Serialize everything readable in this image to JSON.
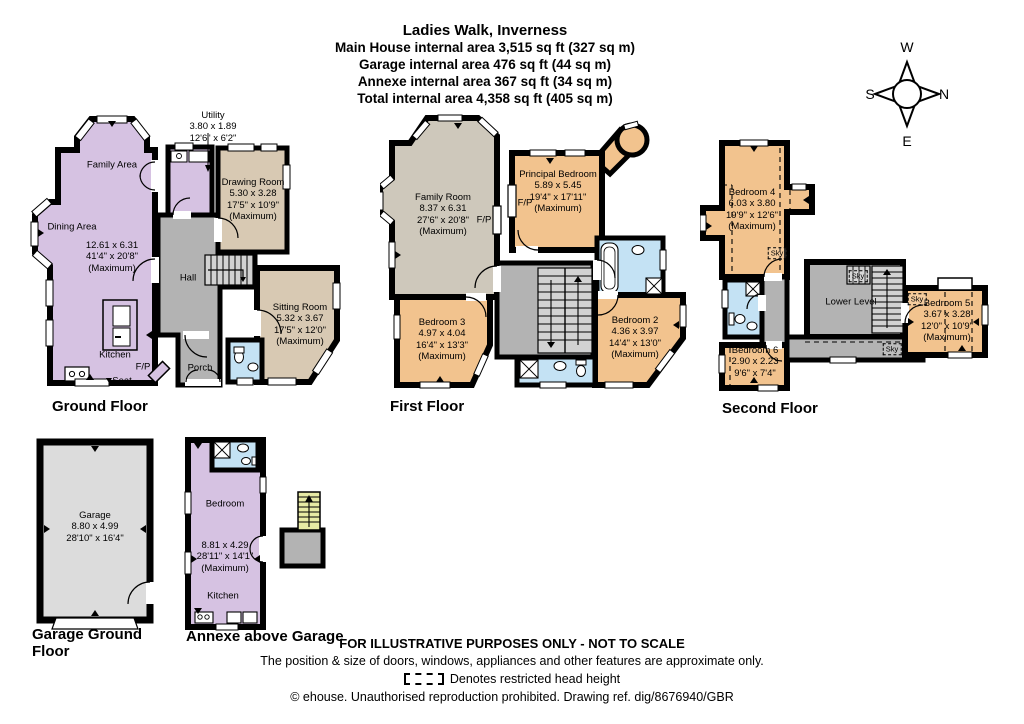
{
  "header": {
    "title": "Ladies Walk, Inverness",
    "area_lines": [
      "Main House internal area 3,515 sq ft (327 sq m)",
      "Garage internal area 476 sq ft (44 sq m)",
      "Annexe internal area 367 sq ft (34 sq m)",
      "Total internal area 4,358 sq ft (405 sq m)"
    ]
  },
  "compass": {
    "top": "W",
    "left": "S",
    "right": "N",
    "bottom": "E"
  },
  "colors": {
    "wall": "#000000",
    "lavender": "#d6c2e2",
    "beige": "#d8c9b3",
    "orange": "#f2c38e",
    "taupe": "#cec8bb",
    "gray": "#b3b3b3",
    "light_gray": "#dcdcdc",
    "stair_gray": "#d2d2d2",
    "blue": "#c4e2f4",
    "stair_yellow": "#e7eaa4",
    "white": "#ffffff"
  },
  "ground_floor": {
    "label": "Ground Floor",
    "family_area": "Family Area",
    "dining_area": "Dining Area",
    "kitchen": "Kitchen",
    "open_plan_dims": [
      "12.61 x 6.31",
      "41'4\" x 20'8\"",
      "(Maximum)"
    ],
    "utility": [
      "Utility",
      "3.80 x 1.89",
      "12'6\" x 6'2\""
    ],
    "drawing_room": [
      "Drawing Room",
      "5.30 x 3.28",
      "17'5\" x 10'9\"",
      "(Maximum)"
    ],
    "sitting_room": [
      "Sitting Room",
      "5.32 x 3.67",
      "17'5\" x 12'0\"",
      "(Maximum)"
    ],
    "hall": "Hall",
    "porch": "Porch",
    "fireplace": "F/P",
    "seat": "Seat"
  },
  "first_floor": {
    "label": "First Floor",
    "family_room": [
      "Family Room",
      "8.37 x 6.31",
      "27'6\" x 20'8\"",
      "(Maximum)"
    ],
    "principal_bedroom": [
      "Principal Bedroom",
      "5.89 x 5.45",
      "19'4\" x 17'11\"",
      "(Maximum)"
    ],
    "bedroom_3": [
      "Bedroom 3",
      "4.97 x 4.04",
      "16'4\" x 13'3\"",
      "(Maximum)"
    ],
    "bedroom_2": [
      "Bedroom 2",
      "4.36 x 3.97",
      "14'4\" x 13'0\"",
      "(Maximum)"
    ],
    "fireplace": "F/P"
  },
  "second_floor": {
    "label": "Second Floor",
    "bedroom_4": [
      "Bedroom 4",
      "6.03 x 3.80",
      "19'9\" x 12'6\"",
      "(Maximum)"
    ],
    "bedroom_5": [
      "Bedroom 5",
      "3.67 x 3.28",
      "12'0\" x 10'9\"",
      "(Maximum)"
    ],
    "bedroom_6": [
      "Bedroom 6",
      "2.90 x 2.23",
      "9'6\" x 7'4\""
    ],
    "lower_level": "Lower Level",
    "sky": "Sky"
  },
  "garage": {
    "label": "Garage Ground Floor",
    "room": [
      "Garage",
      "8.80 x 4.99",
      "28'10\" x 16'4\""
    ]
  },
  "annexe": {
    "label": "Annexe above Garage",
    "bedroom": "Bedroom",
    "kitchen": "Kitchen",
    "dims": [
      "8.81 x 4.29",
      "28'11\" x 14'1\"",
      "(Maximum)"
    ]
  },
  "footer": {
    "line1": "FOR ILLUSTRATIVE PURPOSES ONLY - NOT TO SCALE",
    "line2": "The position & size of doors, windows, appliances and other features are approximate only.",
    "restricted": "Denotes restricted head height",
    "copyright": "© ehouse. Unauthorised reproduction prohibited. Drawing ref. dig/8676940/GBR"
  }
}
